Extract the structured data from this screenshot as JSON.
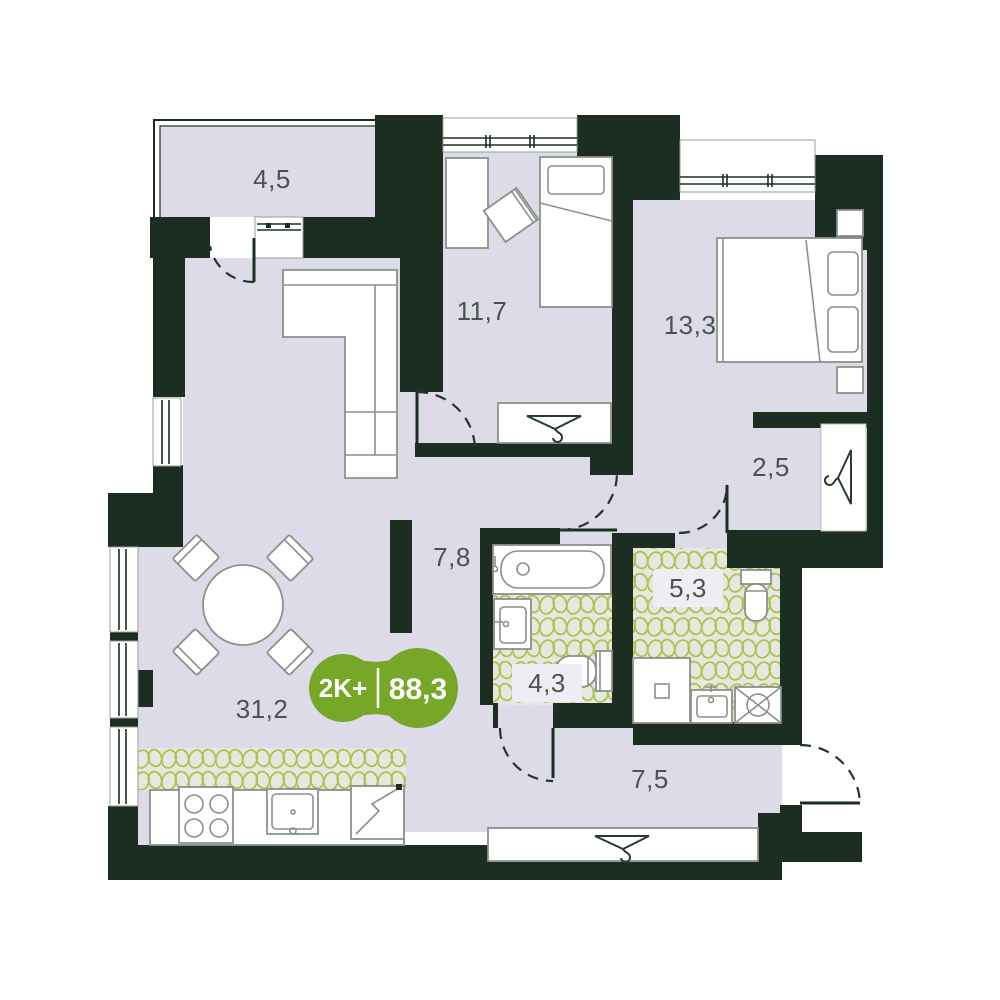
{
  "floorplan": {
    "badge": {
      "type_label": "2K+",
      "area_label": "88,3"
    },
    "rooms": [
      {
        "key": "balcony",
        "area_label": "4,5"
      },
      {
        "key": "bedroom-1",
        "area_label": "11,7"
      },
      {
        "key": "bedroom-2",
        "area_label": "13,3"
      },
      {
        "key": "wardrobe-niche",
        "area_label": "2,5"
      },
      {
        "key": "hall",
        "area_label": "7,8"
      },
      {
        "key": "living-kitchen",
        "area_label": "31,2"
      },
      {
        "key": "bathroom",
        "area_label": "4,3"
      },
      {
        "key": "toilet",
        "area_label": "5,3"
      },
      {
        "key": "hallway",
        "area_label": "7,5"
      }
    ],
    "colors": {
      "wall": "#1C2E21",
      "floor": "#DCDBE7",
      "tile_bg": "#E7E7E0",
      "tile_stroke": "#A9C44E",
      "badge": "#76A727",
      "line": "#8A918A",
      "label": "#4A544C",
      "arc": "#23362A"
    },
    "icons": {
      "wardrobe_marker": "hanger-icon"
    }
  }
}
